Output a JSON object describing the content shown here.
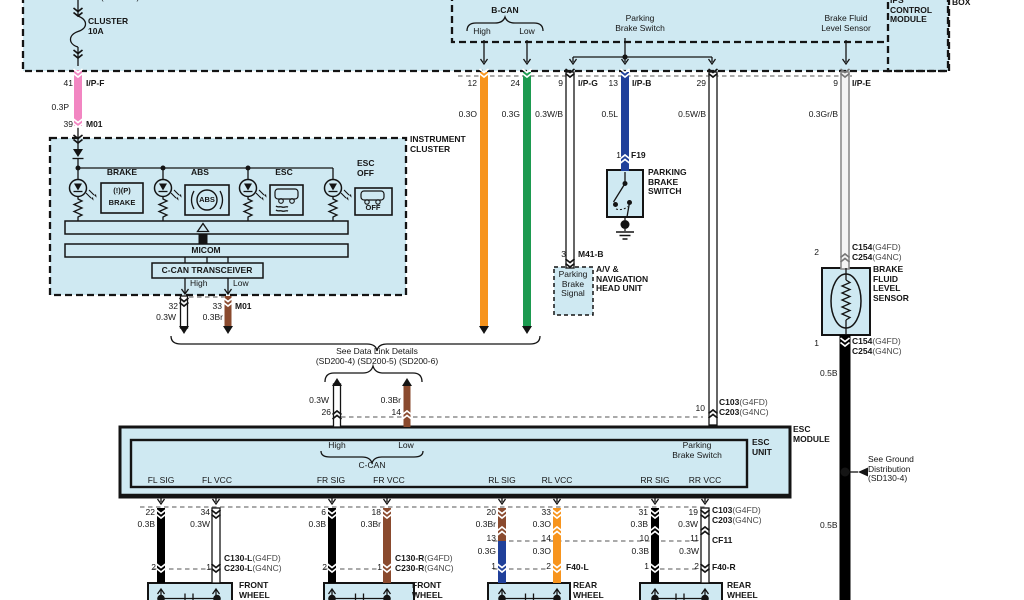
{
  "colors": {
    "panel_fill": "#cfe9f2",
    "wire_pink": "#f286c2",
    "wire_orange": "#f7941d",
    "wire_green": "#1d9a50",
    "wire_blue": "#20409a",
    "wire_brown": "#8a4a2e",
    "wire_black": "#000000",
    "wire_gray_stripe": "#8c8c8c"
  },
  "top": {
    "power_ref": "(SD110-6)",
    "fuse_label": "CLUSTER\n10A",
    "bcan": "B-CAN",
    "bcan_high": "High",
    "bcan_low": "Low",
    "parking_brake_switch": "Parking\nBrake Switch",
    "brake_fluid_sensor": "Brake Fluid\nLevel Sensor",
    "ips_module": "IPS\nCONTROL\nMODULE",
    "box": "BOX"
  },
  "feeds": {
    "p41": "41",
    "ipf": "I/P-F",
    "g_p": "0.3P",
    "p39": "39",
    "m01": "M01",
    "p12": "12",
    "g_o": "0.3O",
    "p24": "24",
    "g_g": "0.3G",
    "p9": "9",
    "ipg": "I/P-G",
    "g_wb": "0.3W/B",
    "p13": "13",
    "ipb": "I/P-B",
    "g_l": "0.5L",
    "p29": "29",
    "g_wb5": "0.5W/B",
    "p9e": "9",
    "ipe": "I/P-E",
    "g_grb": "0.3Gr/B"
  },
  "cluster": {
    "label": "INSTRUMENT\nCLUSTER",
    "brake": "BRAKE",
    "abs": "ABS",
    "esc": "ESC",
    "esc_off": "ESC\nOFF",
    "icon_brake_1": "(!)(P)",
    "icon_brake_2": "BRAKE",
    "icon_abs": "ABS",
    "icon_off": "OFF",
    "micom": "MICOM",
    "transceiver": "C-CAN TRANSCEIVER",
    "high": "High",
    "low": "Low",
    "p32": "32",
    "g_w": "0.3W",
    "p33": "33",
    "g_br": "0.3Br",
    "m01": "M01"
  },
  "datalink": {
    "see": "See Data Link Details",
    "refs": "(SD200-4) (SD200-5) (SD200-6)",
    "g_w": "0.3W",
    "p26": "26",
    "g_br": "0.3Br",
    "p14": "14"
  },
  "pbs": {
    "p1": "1",
    "f19": "F19",
    "label": "PARKING\nBRAKE\nSWITCH"
  },
  "avn": {
    "p3": "3",
    "m41b": "M41-B",
    "signal": "Parking\nBrake\nSignal",
    "label": "A/V &\nNAVIGATION\nHEAD UNIT"
  },
  "bfls": {
    "p2": "2",
    "c154": "C154",
    "c154s": "(G4FD)",
    "c254": "C254",
    "c254s": "(G4NC)",
    "label": "BRAKE\nFLUID\nLEVEL\nSENSOR",
    "p1": "1",
    "g_b1": "0.5B",
    "g_b2": "0.5B"
  },
  "esc": {
    "p10": "10",
    "c103": "C103",
    "c103s": "(G4FD)",
    "c203": "C203",
    "c203s": "(G4NC)",
    "module": "ESC\nMODULE",
    "unit": "ESC\nUNIT",
    "high": "High",
    "low": "Low",
    "ccan": "C-CAN",
    "pbs": "Parking\nBrake Switch",
    "ports": [
      "FL SIG",
      "FL VCC",
      "FR SIG",
      "FR VCC",
      "RL SIG",
      "RL VCC",
      "RR SIG",
      "RR VCC"
    ]
  },
  "ground": {
    "label": "See Ground\nDistribution\n(SD130-4)"
  },
  "wheels": {
    "fl": {
      "ps": "22",
      "gs": "0.3B",
      "pv": "34",
      "gv": "0.3W",
      "p2": "2",
      "p1": "1",
      "c1": "C130-L",
      "c1s": "(G4FD)",
      "c2": "C230-L",
      "c2s": "(G4NC)",
      "box": "FRONT\nWHEEL"
    },
    "fr": {
      "ps": "6",
      "gs": "0.3B",
      "pv": "18",
      "gv": "0.3Br",
      "p2": "2",
      "p1": "1",
      "c1": "C130-R",
      "c1s": "(G4FD)",
      "c2": "C230-R",
      "c2s": "(G4NC)",
      "box": "FRONT\nWHEEL"
    },
    "rl": {
      "ps": "20",
      "gs": "0.3Br",
      "pv": "33",
      "gv": "0.3O",
      "pms": "13",
      "gms": "0.3G",
      "pmv": "14",
      "gmv": "0.3O",
      "p1": "1",
      "p2": "2",
      "conn": "F40-L",
      "box": "REAR\nWHEEL"
    },
    "rr": {
      "ps": "31",
      "gs": "0.3B",
      "pv": "19",
      "gv": "0.3W",
      "c1": "C103",
      "c1s": "(G4FD)",
      "c2": "C203",
      "c2s": "(G4NC)",
      "pms": "10",
      "gms": "0.3B",
      "pmv": "11",
      "gmv": "0.3W",
      "cf": "CF11",
      "p1": "1",
      "p2": "2",
      "conn": "F40-R",
      "box": "REAR\nWHEEL"
    }
  }
}
